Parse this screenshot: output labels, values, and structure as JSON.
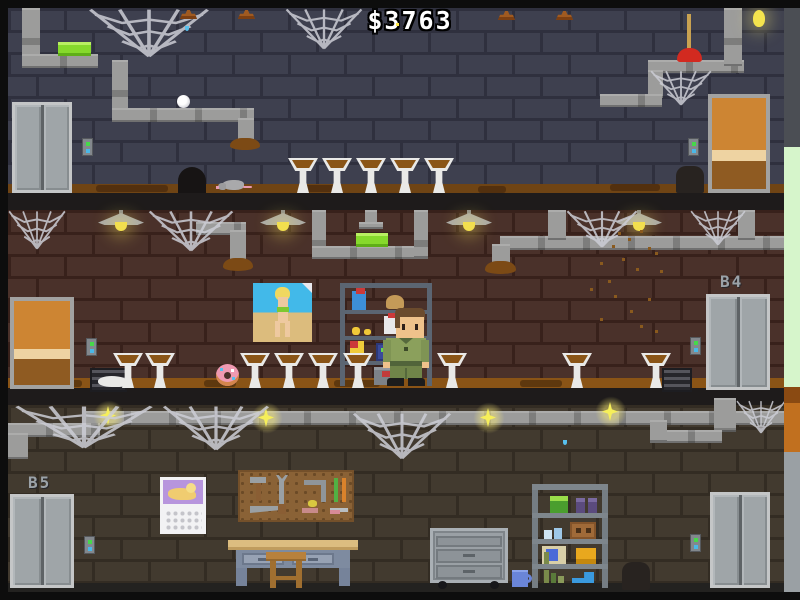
{
  "hud": {
    "money": "$3763"
  },
  "floors": {
    "b4_label": "B4",
    "b5_label": "B5"
  },
  "colors": {
    "money_text": "#ffffff",
    "floor_label": "#9ba2a8",
    "wall_top": "#3e404f",
    "wall_middle": "#4a312a",
    "wall_bottom": "#423a2f",
    "pipe_metal": "#9c9c9b",
    "dirt_floor": "#8a5416",
    "green_item": "#86d92c",
    "lamp_light": "#f2df4e",
    "elevator_metal": "#9fa5a8",
    "wood_door": "#cd8533",
    "call_button_green": "#46d84a",
    "call_button_blue": "#4ab8e8"
  }
}
